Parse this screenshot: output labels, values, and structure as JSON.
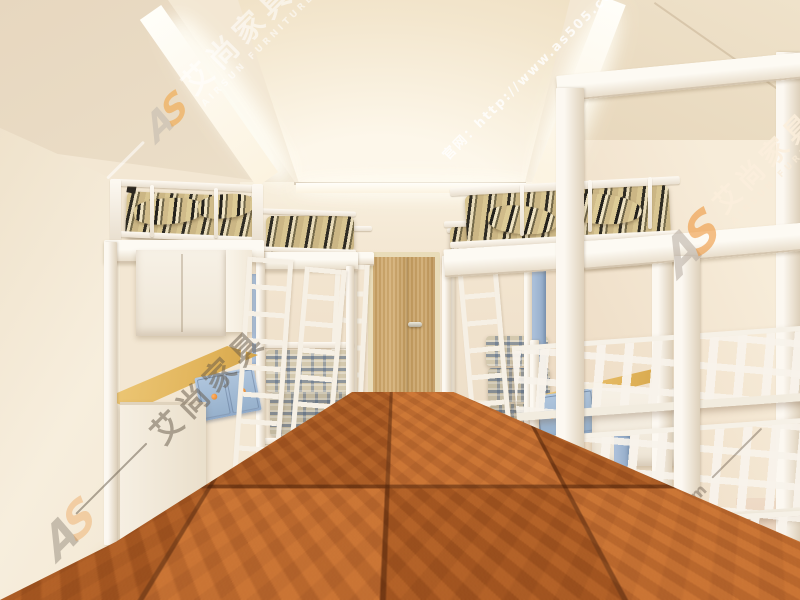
{
  "watermark": {
    "logo_a": "A",
    "logo_s": "S",
    "brand_cn": "艾尚家具",
    "brand_en": "AIRSUN FURNITURE",
    "site_url": "官网：http://www.as505.com",
    "site_short": "as505.com"
  },
  "colors": {
    "accent_orange": "#ef8f3a",
    "logo_grey": "#9a9188",
    "wall_cream": "#f3e7d3",
    "ceiling_beige": "#ead9bf",
    "cove_light": "#fffdf4",
    "floor_brown": "#b4591f",
    "door_wood": "#c7a36a",
    "drawer_blue": "#a3bcd8",
    "desk_wood": "#e4bd66",
    "bed_frame_white": "#f8f3ea",
    "bedding_stripe_dark": "#2e2b23",
    "bedding_stripe_beige": "#d8c591"
  }
}
